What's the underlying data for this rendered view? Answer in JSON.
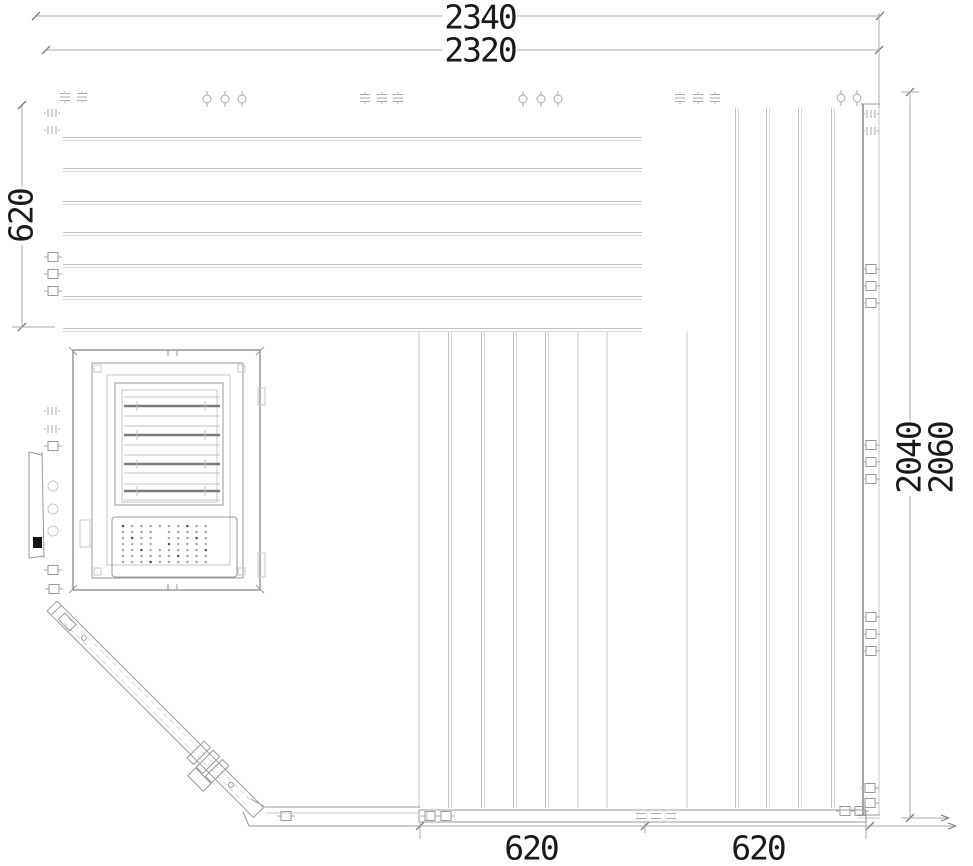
{
  "dimensions": {
    "top_outer": "2340",
    "top_inner": "2320",
    "left": "620",
    "right_inner": "2040",
    "right_outer": "2060",
    "bottom_left": "620",
    "bottom_right": "620"
  },
  "drawing": {
    "canvas": {
      "w": 973,
      "h": 866,
      "background": "#ffffff"
    },
    "colors": {
      "hairline": "#c9c9c9",
      "hairline2": "#d8d8d8",
      "board": "#c4c4c4",
      "frame": "#9a9a9a",
      "edge": "#7e7e7e",
      "slat_dark": "#7d7d7d",
      "dim_line": "#ababab",
      "dim_tick": "#7f7f7f",
      "clip": "#aaaaaa",
      "text": "#1a1a1a",
      "dark_fill": "#151515",
      "dot": "#adadad",
      "dot_dark": "#5a5a5a"
    },
    "top_wall": {
      "x1": 63,
      "x2": 642,
      "board_lines_y": [
        139,
        170,
        203,
        234,
        266,
        298,
        330
      ]
    },
    "right_wall": {
      "top": 108,
      "bottom": 808,
      "board_lines_x": [
        737,
        768,
        800,
        833
      ],
      "edge_x": 863,
      "edge_top": 104,
      "edge_bottom": 815,
      "face_x": 879,
      "face_top": 13,
      "face_bottom": 815
    },
    "floor_panel": {
      "top": 332,
      "bottom": 808,
      "board_pairs_x": [
        450,
        483,
        515,
        547
      ],
      "board_singles_x": [
        419,
        578,
        607,
        687
      ]
    },
    "rail": {
      "x1": 419,
      "x2": 866,
      "y1": 810,
      "y2": 822,
      "left_x2": 420,
      "left_y1": 807,
      "left_y2": 826
    },
    "heater": {
      "outer": [
        73,
        350,
        187,
        240
      ],
      "frame2": [
        92,
        363,
        151,
        215
      ],
      "frame3": [
        107,
        375,
        123,
        190
      ],
      "louver_outer": [
        115,
        383,
        108,
        122
      ],
      "louver_inner": [
        122,
        390,
        95,
        112
      ],
      "slat_x": [
        124,
        220
      ],
      "slats_thin_y": [
        397,
        416,
        426,
        445,
        455,
        473,
        484,
        500
      ],
      "slats_dark_y": [
        406,
        435,
        464,
        491
      ],
      "tick_x": [
        137,
        205
      ],
      "perf": [
        112,
        517,
        125,
        60
      ],
      "dots": {
        "x0": 123,
        "dx": 9.2,
        "cols": 10,
        "y0": 526,
        "dy": 6,
        "rows": 7,
        "r": 1.3
      },
      "tabs": [
        [
          258,
          388,
          7,
          17
        ],
        [
          258,
          553,
          7,
          24
        ],
        [
          80,
          520,
          10,
          27
        ]
      ],
      "corner_squares": [
        [
          94,
          365
        ],
        [
          238,
          365
        ],
        [
          94,
          568
        ],
        [
          238,
          568
        ]
      ],
      "notch_x": [
        168,
        177
      ]
    },
    "side_strip": {
      "x1": 29,
      "x2": 43,
      "y1": 452,
      "y2": 558,
      "circle_x": 53,
      "circle_r": 5,
      "circles_y": [
        486,
        509,
        531
      ],
      "dark_mark": [
        33,
        537,
        9,
        11
      ]
    },
    "diagonal": {
      "tx": 52,
      "ty": 606,
      "len": 292,
      "hw": 7,
      "inner_off": 3,
      "end_cap": 6,
      "notch": [
        14,
        -4,
        16,
        9
      ],
      "circles": [
        [
          45,
          0
        ],
        [
          253,
          0
        ]
      ],
      "rungs": [
        [
          203,
          -12,
          9,
          24
        ],
        [
          216,
          -12,
          9,
          24
        ],
        [
          229,
          -12,
          9,
          24
        ]
      ],
      "bracket": [
        216,
        13,
        22,
        11
      ]
    },
    "dims_geo": {
      "d2340": {
        "y": 16,
        "x1": 36,
        "x2": 880
      },
      "d2320": {
        "y": 50,
        "x1": 46,
        "x2": 879
      },
      "d620L": {
        "x": 22,
        "y1": 105,
        "y2": 327,
        "stub": [
          12,
          327,
          55,
          327
        ]
      },
      "d2040": {
        "x": 910,
        "y1": 92,
        "y2": 818,
        "top_stub": [
          901,
          92,
          919,
          92
        ],
        "bot_stub": [
          901,
          818,
          949,
          818
        ]
      },
      "ext_right": {
        "x": 879,
        "y1": 13,
        "y2": 108
      },
      "bottom": {
        "y": 826,
        "x1": 420,
        "x2": 956,
        "ticks": [
          420,
          645,
          870
        ],
        "stubs": [
          [
            420,
            822,
            420,
            839
          ],
          [
            645,
            823,
            645,
            833
          ],
          [
            866,
            822,
            866,
            839
          ]
        ]
      }
    },
    "clips": [
      [
        "dash",
        65,
        97
      ],
      [
        "dash",
        82,
        97
      ],
      [
        "circle",
        207,
        99
      ],
      [
        "circle",
        225,
        99
      ],
      [
        "circle",
        242,
        99
      ],
      [
        "dash",
        365,
        98
      ],
      [
        "dash",
        382,
        98
      ],
      [
        "dash",
        398,
        98
      ],
      [
        "circle",
        523,
        99
      ],
      [
        "circle",
        541,
        99
      ],
      [
        "circle",
        558,
        99
      ],
      [
        "dash",
        680,
        98
      ],
      [
        "dash",
        698,
        98
      ],
      [
        "dash",
        715,
        98
      ],
      [
        "circle",
        841,
        98
      ],
      [
        "circle",
        857,
        98
      ],
      [
        "vbar",
        52,
        113
      ],
      [
        "vbar",
        52,
        130
      ],
      [
        "square",
        53,
        257
      ],
      [
        "square",
        53,
        274
      ],
      [
        "square",
        53,
        291
      ],
      [
        "vbar",
        52,
        411
      ],
      [
        "vbar",
        52,
        429
      ],
      [
        "square",
        53,
        446
      ],
      [
        "square",
        53,
        570
      ],
      [
        "square",
        54,
        589
      ],
      [
        "vbar",
        871,
        114
      ],
      [
        "vbar",
        871,
        131
      ],
      [
        "square",
        871,
        269
      ],
      [
        "square",
        871,
        286
      ],
      [
        "square",
        871,
        303
      ],
      [
        "square",
        871,
        445
      ],
      [
        "square",
        871,
        462
      ],
      [
        "square",
        871,
        479
      ],
      [
        "square",
        871,
        617
      ],
      [
        "square",
        871,
        634
      ],
      [
        "square",
        871,
        651
      ],
      [
        "square",
        870,
        788
      ],
      [
        "square",
        870,
        803
      ],
      [
        "square",
        286,
        816
      ],
      [
        "square",
        430,
        816
      ],
      [
        "square",
        446,
        816
      ],
      [
        "hdash",
        641,
        816
      ],
      [
        "hdash",
        656,
        816
      ],
      [
        "hdash",
        671,
        816
      ],
      [
        "square",
        845,
        811
      ],
      [
        "square",
        860,
        811
      ]
    ]
  }
}
